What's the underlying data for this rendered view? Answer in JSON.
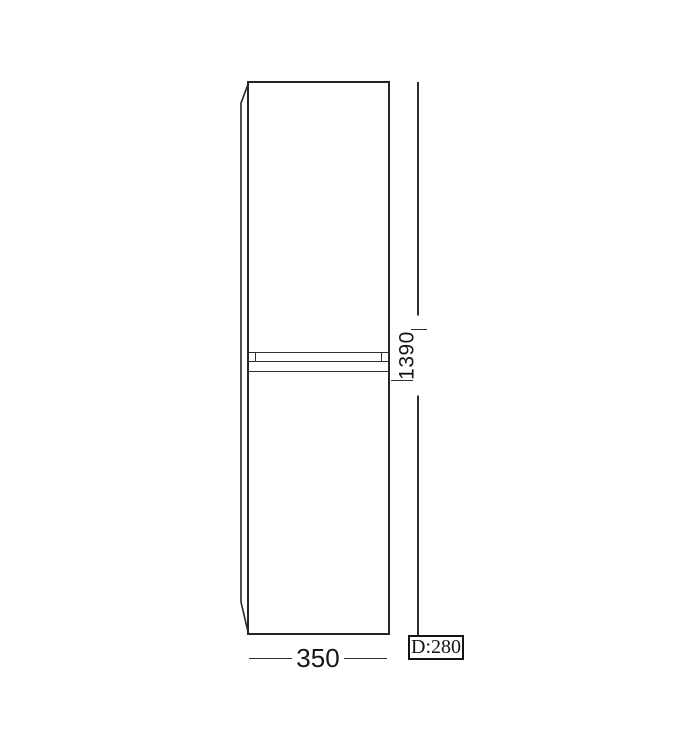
{
  "meta": {
    "background_color": "#ffffff",
    "line_color": "#2e2e2e",
    "text_color": "#151515",
    "description": "Technical dimension drawing of a tall two-door cabinet, front elevation"
  },
  "drawing": {
    "height_dimension": {
      "value": "1390"
    },
    "width_dimension": {
      "value": "350"
    },
    "depth_dimension": {
      "value": "D:280"
    }
  }
}
